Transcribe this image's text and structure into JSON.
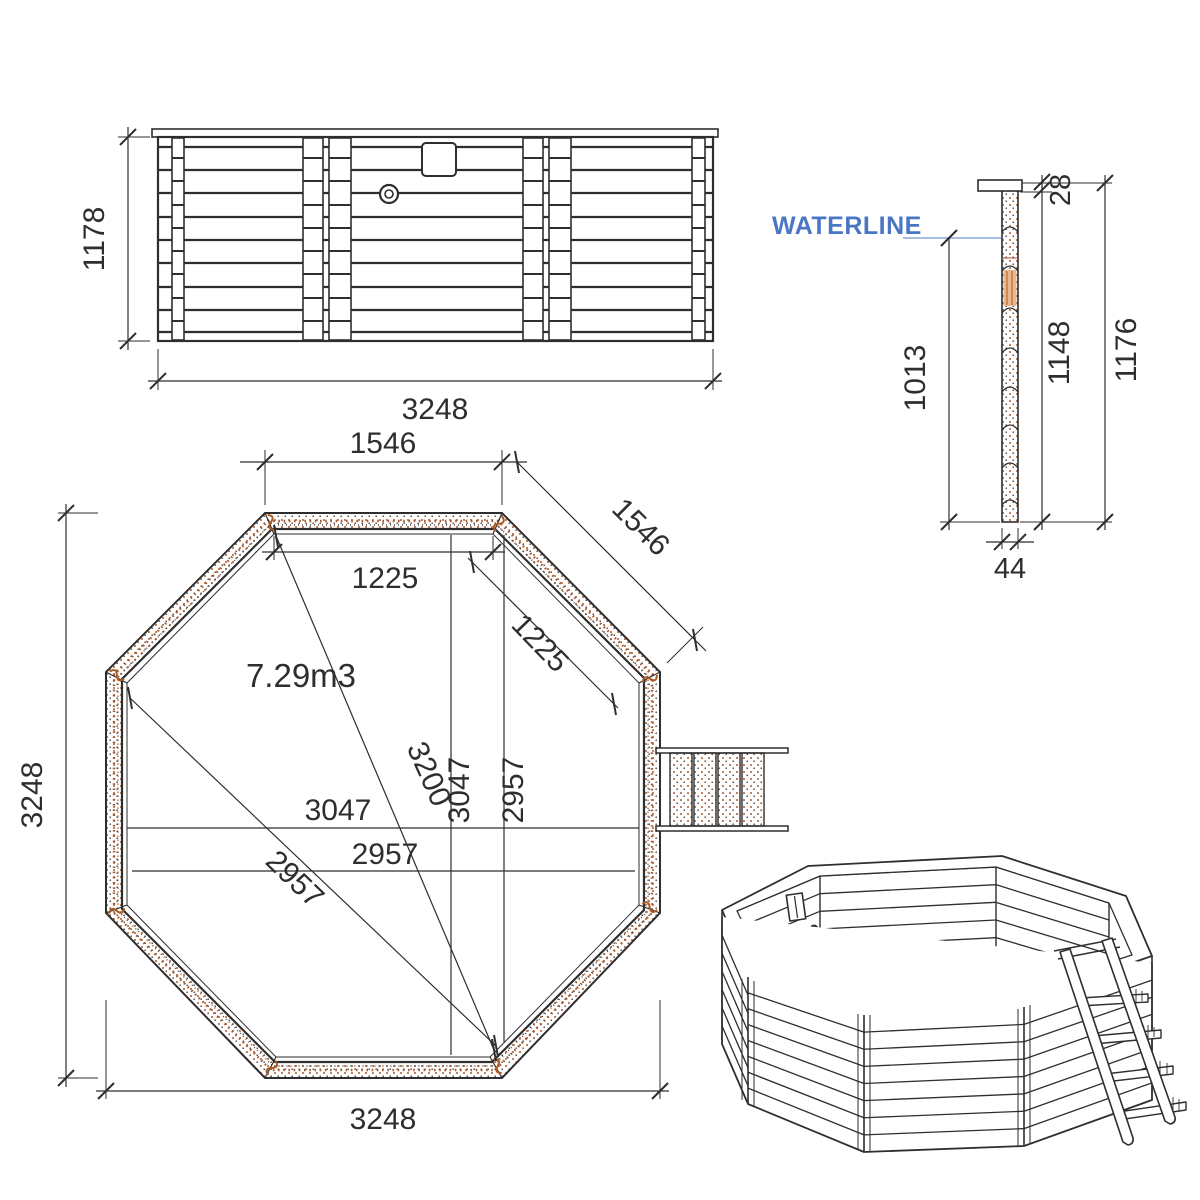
{
  "drawing_type": "octagonal-wooden-pool-technical-drawing",
  "colors": {
    "line": "#2e2e2e",
    "waterline_blue": "#4a77c4",
    "stipple_brown": "#a9572a",
    "stipple_dark": "#5a4a42",
    "hatch_orange": "#e8b98e",
    "hatch_orange_line": "#c4763c"
  },
  "elevation": {
    "height": "1178",
    "width": "3248"
  },
  "section": {
    "waterline_label": "WATERLINE",
    "cap_thickness": "28",
    "water_depth": "1013",
    "wall_height": "1148",
    "total_height": "1176",
    "plank_thickness": "44"
  },
  "plan": {
    "volume": "7.29m3",
    "top_side": "1546",
    "diagonal_side": "1546",
    "inner_top": "1225",
    "inner_diagonal_side": "1225",
    "long_diagonal": "3200",
    "inner_width_h": "3047",
    "inner_width_v": "3047",
    "floor_width_h": "2957",
    "floor_width_v": "2957",
    "floor_diagonal": "2957",
    "overall_width": "3248",
    "overall_height": "3248"
  }
}
